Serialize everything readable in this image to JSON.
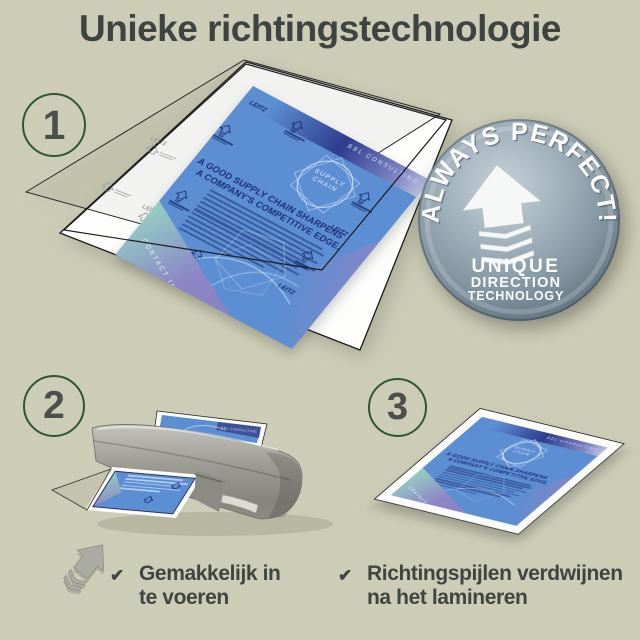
{
  "title": "Unieke richtingstechnologie",
  "colors": {
    "background": "#cdccb6",
    "heading_text": "#3d4442",
    "step_circle_border": "#2d5733",
    "step_number": "#4b504e",
    "document_blue": "#5b8ed2",
    "document_navy": "#1f2f7c",
    "badge_steel": "#8fa2ae",
    "laminator_grey": "#97978f",
    "checklist_text": "#3e4543"
  },
  "steps": [
    {
      "number": "1"
    },
    {
      "number": "2"
    },
    {
      "number": "3"
    }
  ],
  "badge": {
    "arc_text": "ALWAYS PERFECT!",
    "caption_line1": "UNIQUE",
    "caption_line2": "DIRECTION",
    "caption_line3": "TECHNOLOGY"
  },
  "document": {
    "brand_top": "BBL CONSULTING",
    "emblem_line1": "SUPPLY",
    "emblem_line2": "CHAIN",
    "headline_line1": "A GOOD SUPPLY CHAIN SHARPENS",
    "headline_line2": "A COMPANY'S COMPETITIVE EDGE.",
    "footer": "CONTACT Info",
    "logo_mark": "LEITZ"
  },
  "checklist": {
    "left": {
      "check": "✔",
      "line1": "Gemakkelijk in",
      "line2": "te voeren"
    },
    "right": {
      "check": "✔",
      "line1": "Richtingspijlen verdwijnen",
      "line2": "na het lamineren"
    }
  }
}
